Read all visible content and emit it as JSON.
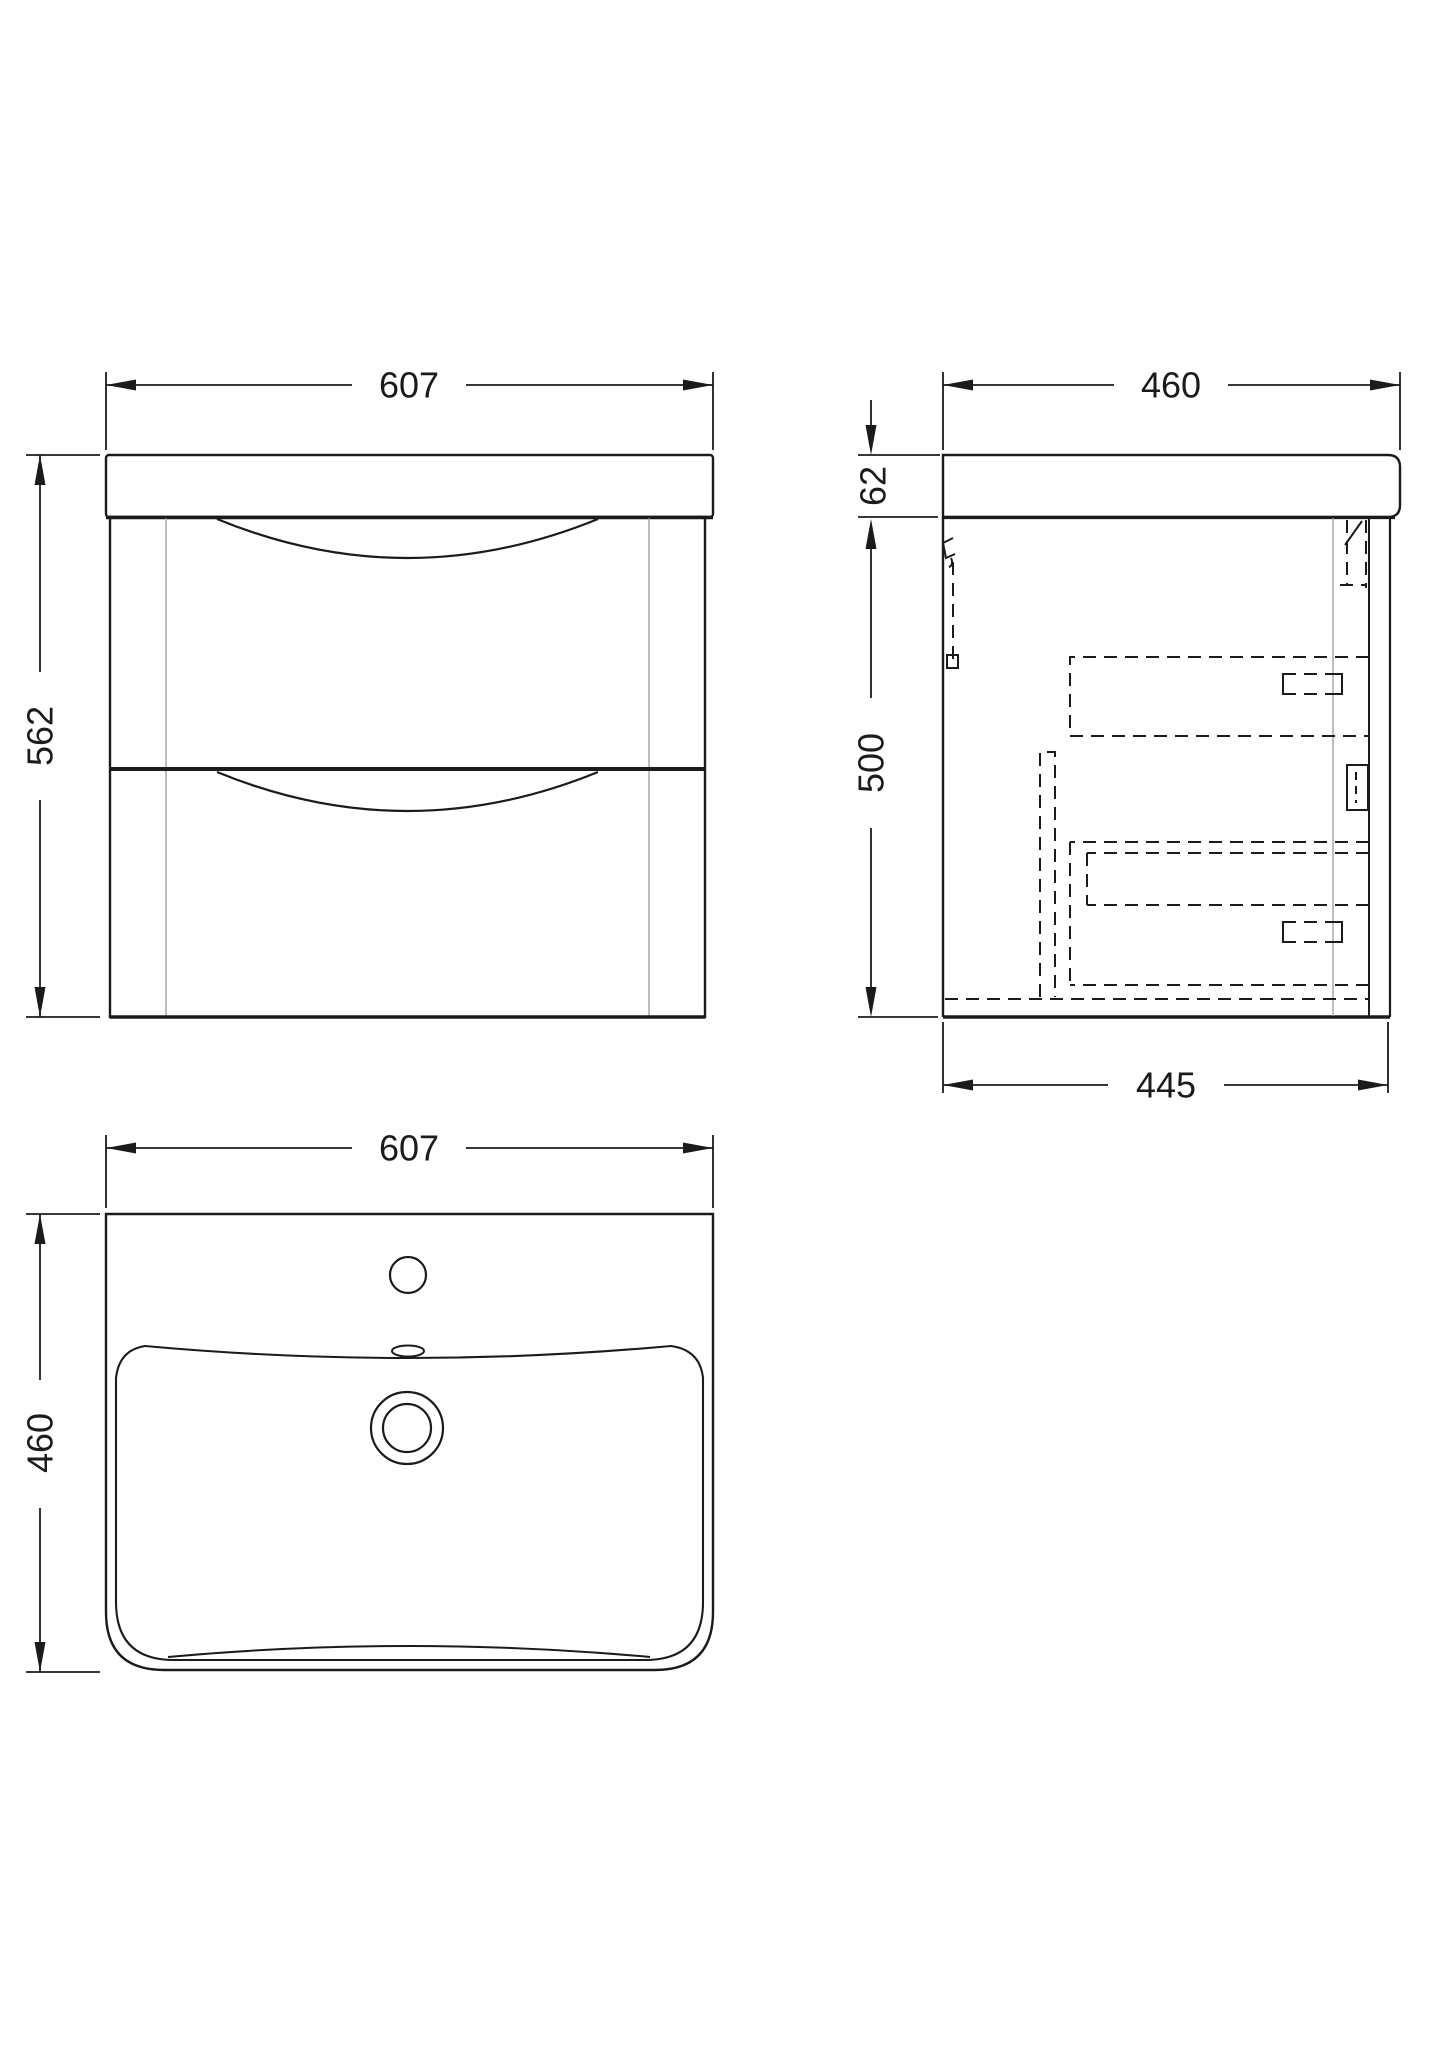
{
  "drawing": {
    "front_view": {
      "width_mm": "607",
      "height_mm": "562"
    },
    "side_view": {
      "depth_mm": "460",
      "worktop_height_mm": "62",
      "cabinet_height_mm": "500",
      "cabinet_depth_mm": "445"
    },
    "plan_view": {
      "width_mm": "607",
      "depth_mm": "460"
    }
  },
  "colors": {
    "line": "#1b1b1b",
    "thin_line": "#9b9b9b",
    "background": "#ffffff"
  }
}
